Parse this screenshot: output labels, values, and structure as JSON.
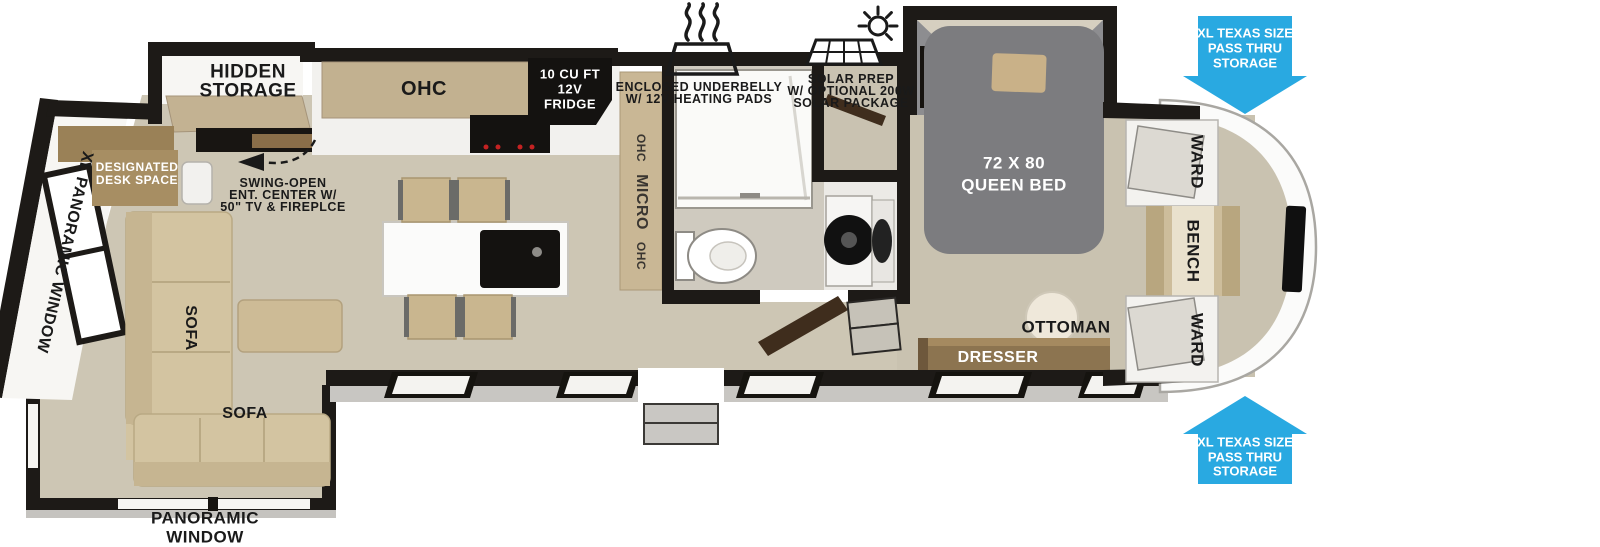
{
  "colors": {
    "accent_blue": "#29a9e1",
    "wall": "#1d1a17",
    "floor_tan": "#cdc6b4",
    "bedroom_floor": "#c9c2b0",
    "furniture_tan": "#d3c4a1",
    "wood": "#9a8157",
    "bed_gray": "#7c7c7f"
  },
  "callouts": {
    "underbelly": {
      "icon": "heat-waves-icon",
      "line1": "ENCLOSED UNDERBELLY",
      "line2": "W/ 12V HEATING PADS"
    },
    "solar": {
      "icon": "solar-panel-sun-icon",
      "line1": "SOLAR PREP",
      "line2": "W/ OPTIONAL 200W",
      "line3": "SOLAR PACKAGE"
    },
    "pass_thru_top": {
      "icon": "arrow-down-icon",
      "line1": "XL TEXAS SIZE",
      "line2": "PASS THRU",
      "line3": "STORAGE"
    },
    "pass_thru_bottom": {
      "icon": "arrow-up-icon",
      "line1": "XL TEXAS SIZE",
      "line2": "PASS THRU",
      "line3": "STORAGE"
    }
  },
  "living": {
    "hidden_storage": {
      "line1": "HIDDEN",
      "line2": "STORAGE"
    },
    "ohc": "OHC",
    "fridge": {
      "line1": "10 CU FT",
      "line2": "12V",
      "line3": "FRIDGE"
    },
    "ent_center": {
      "line1": "SWING-OPEN",
      "line2": "ENT. CENTER W/",
      "line3": "50\" TV & FIREPLCE"
    },
    "desk": {
      "line1": "DESIGNATED",
      "line2": "DESK SPACE"
    },
    "sofa_rear": "SOFA",
    "sofa_front": "SOFA",
    "xl_panoramic_window": "XL PANORAMIC WINDOW",
    "panoramic_window": {
      "line1": "PANORAMIC",
      "line2": "WINDOW"
    }
  },
  "kitchen": {
    "ohc_upper": "OHC",
    "micro": "MICRO",
    "ohc_lower": "OHC"
  },
  "bedroom": {
    "queen_bed": {
      "line1": "72 X 80",
      "line2": "QUEEN BED"
    },
    "ottoman": "OTTOMAN",
    "dresser": "DRESSER",
    "ward_top": "WARD",
    "bench": "BENCH",
    "ward_bottom": "WARD"
  }
}
